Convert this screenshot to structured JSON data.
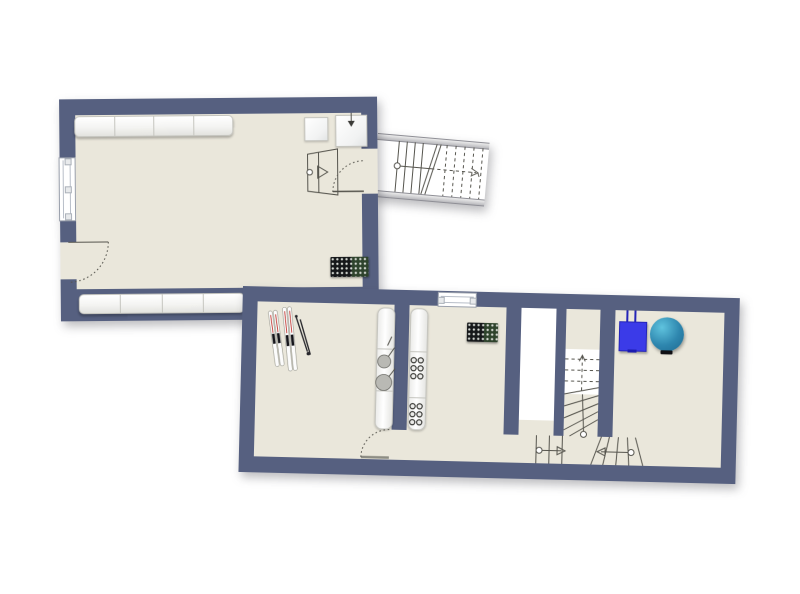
{
  "document": {
    "type": "architectural floor plan",
    "label": "Two-level apartment floor plan",
    "visible_text": []
  },
  "colors": {
    "background": "#ffffff",
    "wall": "#566080",
    "floor": "#eae7db",
    "fixture-edge": "#c5c5bf",
    "line": "#55544d",
    "radiator": "#16181a",
    "radiator-dot": "#d6dad4",
    "boiler-blue": "#3b3be8",
    "boiler-blue-dark": "#2424b8",
    "tank-teal-light": "#5fc3de",
    "tank-teal": "#2e86ae",
    "tank-teal-dark": "#1e6990",
    "ski-red": "#c23b35",
    "pan-gray": "#b9b9b4"
  },
  "floors": {
    "upper": {
      "label": "Upper room",
      "fixtures": {
        "cabinets_top": "Cabinet row along top wall",
        "appliance_small": "Small appliance",
        "appliance_arrow": "Appliance with down arrow",
        "window": "Window in left wall",
        "entry_door": "Hinged door with swing arc",
        "stair_door": "Door to staircase",
        "steps": "Entry steps with walkline and arrow",
        "radiator": "Radiator",
        "cabinets_bottom": "Cabinet row along bottom wall"
      }
    },
    "corridor": {
      "label": "Straight staircase with break line and walkline arrow"
    },
    "lower": {
      "label": "Lower floor",
      "rooms": {
        "storage": "Storage room with skis and poles",
        "kitchen": "Kitchen counters with pans and cooktop burners",
        "hall": "Hallway with radiator and exterior window",
        "stairwell": "Winder staircase with stairwell void",
        "utility": "Utility room with boiler and round tank"
      },
      "fixtures": {
        "skis": "Two pairs of skis with poles",
        "counter_left": "Counter with two pans",
        "counter_right": "Counter with two 6-burner cooktops",
        "window_top": "Window in top wall",
        "radiator": "Radiator",
        "hall_door": "Hinged door with swing arc",
        "void": "Stairwell void",
        "boiler": "Wall-mounted boiler",
        "tank": "Round tank"
      }
    }
  }
}
